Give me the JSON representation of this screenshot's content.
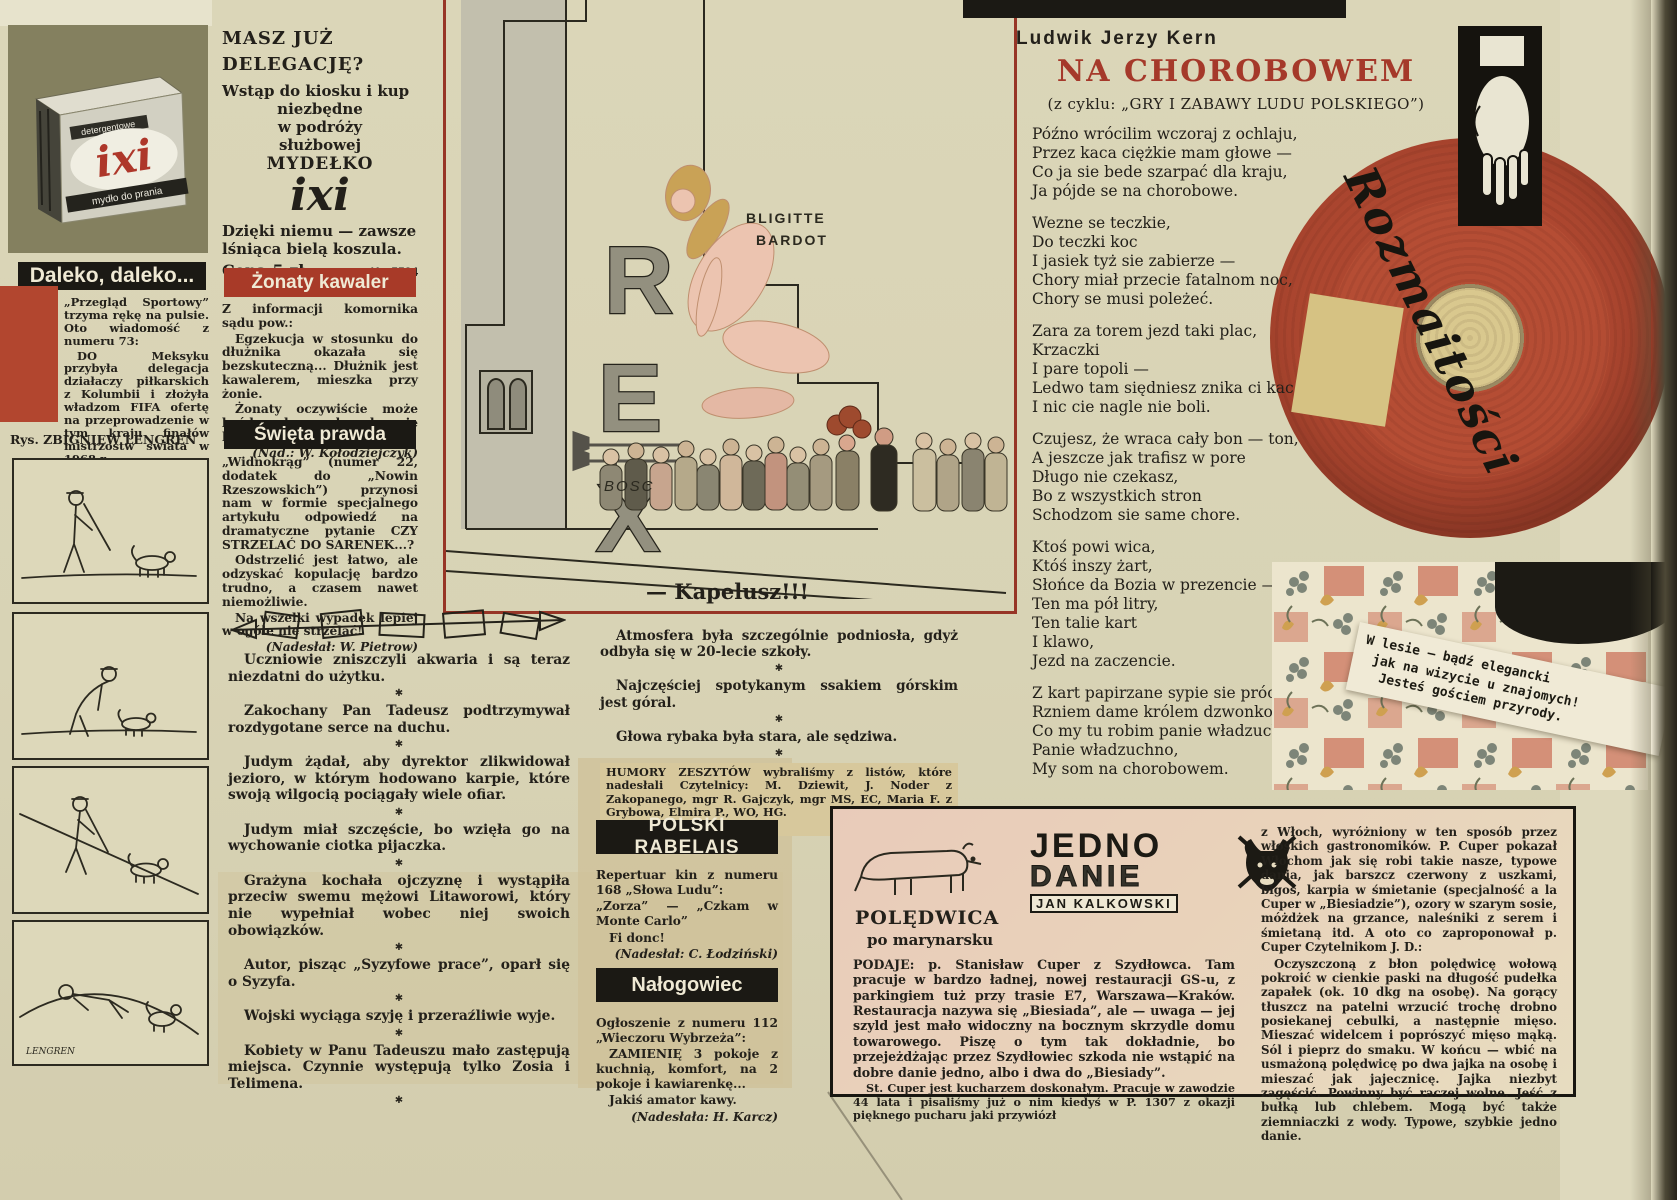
{
  "misc": {
    "star": "✱"
  },
  "ixi_ad": {
    "box_label_top": "detergentowe",
    "box_brand": "ixi",
    "box_label_bottom": "mydło do prania",
    "headline1": "MASZ JUŻ",
    "headline2": "DELEGACJĘ?",
    "line1": "Wstąp do kiosku i kup",
    "line2": "niezbędne",
    "line3": "w podróży",
    "line4": "służbowej",
    "line5": "MYDEŁKO",
    "brand_big": "ixi",
    "slogan1": "Dzięki niemu — zawsze",
    "slogan2": "lśniąca bielą koszula.",
    "price": "Cena 5 zł.",
    "code": "K—5524"
  },
  "daleko": {
    "title": "Daleko, daleko...",
    "p1": "„Przegląd Sportowy” trzyma rękę na pulsie. Oto wiadomość z numeru 73:",
    "p2": "DO Meksyku przybyła delegacja działaczy piłkarskich z Kolumbii i złożyła władzom FIFA ofertę na przeprowadzenie w tym kraju finałów mistrzostw świata w 1968 r.",
    "p3": "Zaczynamy grać do tyłu?",
    "credit": "(Nadesłał: J. Tuna)"
  },
  "lengren": {
    "credit": "Rys. ZBIGNIEW LENGREN",
    "signature": "LENGREN"
  },
  "zonaty": {
    "title": "Żonaty kawaler",
    "p1": "Z informacji komornika sądu pow.:",
    "p2": "Egzekucja w stosunku do dłużnika okazała się bezskuteczną... Dłużnik jest kawalerem, mieszka przy żonie.",
    "p3": "Żonaty oczywiście może być kawalerem ale wyłącznie kawalerem orderu.",
    "credit": "(Nad.: W. Kołodziejczyk)"
  },
  "swieta": {
    "title": "Święta prawda",
    "p1": "„Widnokrąg” (numer 22, dodatek do „Nowin Rzeszowskich”) przynosi nam w formie specjalnego artykułu odpowiedź na dramatyczne pytanie CZY STRZELAĆ DO SARENEK...?",
    "p2": "Odstrzelić jest łatwo, ale odzyskać kopulację bardzo trudno, a czasem nawet niemożliwie.",
    "p3": "Na wszelki wypadek lepiej w ogóle nie strzelać!",
    "credit": "(Nadesłał: W. Pietrow)"
  },
  "cartoon": {
    "sign_letter1": "R",
    "sign_letter2": "E",
    "sign_letter3": "X",
    "poster_line1": "BLIGITTE",
    "poster_line2": "BARDOT",
    "signature": "BOSC",
    "caption": "— Kapelusz!!!"
  },
  "poem": {
    "author": "Ludwik Jerzy Kern",
    "title": "NA CHOROBOWEM",
    "subtitle": "(z cyklu: „GRY I ZABAWY LUDU POLSKIEGO”)",
    "stanzas": [
      [
        "Późno wrócilim wczoraj z ochlaju,",
        "Przez kaca ciężkie mam głowe —",
        "Co ja sie bede szarpać dla kraju,",
        "Ja pójde se na chorobowe."
      ],
      [
        "Wezne se teczkie,",
        "Do teczki koc",
        "I jasiek tyż sie zabierze —",
        "Chory miał przecie fatalnom noc,",
        "Chory se musi poleżeć."
      ],
      [
        "Zara za torem jezd taki plac,",
        "Krzaczki",
        "I pare topoli —",
        "Ledwo tam siędniesz znika ci kac",
        "I nic cie nagle nie boli."
      ],
      [
        "Czujesz, że wraca cały bon — ton,",
        "A jeszcze jak trafisz w pore",
        "Długo nie czekasz,",
        "Bo z wszystkich stron",
        "Schodzom sie same chore."
      ],
      [
        "Ktoś powi wica,",
        "Któś inszy żart,",
        "Słońce da Bozia w prezencie —",
        "Ten ma pół litry,",
        "Ten talie kart",
        "I klawo,",
        "Jezd na zaczencie."
      ],
      [
        "Z kart papirzane sypie sie próchno,",
        "Rzniem dame królem dzwonkowem —",
        "Co my tu robim panie władzuchno?",
        "Panie władzuchno,",
        "My som na chorobowem."
      ]
    ]
  },
  "rozmaitosci": {
    "label": "Rozmaitości"
  },
  "forest_note": {
    "line1": "W lesie — bądź elegancki",
    "line2": "jak na wizycie u znajomych!",
    "line3": "Jesteś gościem przyrody."
  },
  "center_quotes": {
    "q1": "Atmosfera była szczególnie podniosła, gdyż odbyła się w 20-lecie szkoły.",
    "q2": "Najczęściej spotykanym ssakiem górskim jest góral.",
    "q3": "Głowa rybaka była stara, ale sędziwa.",
    "credit": "HUMORY ZESZYTÓW wybraliśmy z listów, które nadesłali Czytelnicy: M. Dziewit, J. Noder z Zakopanego, mgr R. Gajczyk, mgr MS, EC, Maria F. z Grybowa, Elmira P., WO, HG.",
    "thanks": "Dziękujemy."
  },
  "left_quotes": [
    "Uczniowie zniszczyli akwaria i są teraz niezdatni do użytku.",
    "Zakochany Pan Tadeusz podtrzymywał rozdygotane serce na duchu.",
    "Judym żądał, aby dyrektor zlikwidował jezioro, w którym hodowano karpie, które swoją wilgocią pociągały wiele ofiar.",
    "Judym miał szczęście, bo wzięła go na wychowanie ciotka pijaczka.",
    "Grażyna kochała ojczyznę i wystąpiła przeciw swemu mężowi Litaworowi, który nie wypełniał wobec niej swoich obowiązków.",
    "Autor, pisząc „Syzyfowe prace”, oparł się o Syzyfa.",
    "Wojski wyciąga szyję i przeraźliwie wyje.",
    "Kobiety w Panu Tadeuszu mało zastępują miejsca. Czynnie występują tylko Zosia i Telimena."
  ],
  "rabelais": {
    "title": "POLSKI RABELAIS",
    "p1": "Repertuar kin z numeru 168 „Słowa Ludu”:",
    "p2": "„Zorza” — „Czkam w Monte Carlo”",
    "p3": "Fi donc!",
    "credit": "(Nadesłał: C. Łodziński)"
  },
  "nalogowiec": {
    "title": "Nałogowiec",
    "p1": "Ogłoszenie z numeru 112 „Wieczoru Wybrzeża”:",
    "p2": "ZAMIENIĘ 3 pokoje z kuchnią, komfort, na 2 pokoje i kawiarenkę...",
    "p3": "Jakiś amator kawy.",
    "credit": "(Nadesłała: H. Karcz)"
  },
  "recipe": {
    "stamp_line1": "JEDNO",
    "stamp_line2": "DANIE",
    "stamp_line3": "JAN KALKOWSKI",
    "title": "POLĘDWICA",
    "subtitle": "po marynarsku",
    "left_p1": "PODAJE: p. Stanisław Cuper z Szydłowca. Tam pracuje w bardzo ładnej, nowej restauracji GS-u, z parkingiem tuż przy trasie E7, Warszawa—Kraków. Restauracja nazywa się „Biesiada”, ale — uwaga — jej szyld jest mało widoczny na bocznym skrzydle domu towarowego. Piszę o tym tak dokładnie, bo przejeżdżając przez Szydłowiec szkoda nie wstąpić na dobre danie jedno, albo i dwa do „Biesiady”.",
    "left_p2": "St. Cuper jest kucharzem doskonałym. Pracuje w zawodzie 44 lata i pisaliśmy już o nim kiedyś w P. 1307 z okazji pięknego pucharu jaki przywiózł",
    "right_p1": "z Włoch, wyróżniony w ten sposób przez włoskich gastronomików. P. Cuper pokazał Włochom jak się robi takie nasze, typowe dania, jak barszcz czerwony z uszkami, bigos, karpia w śmietanie (specjalność a la Cuper w „Biesiadzie”), ozory w szarym sosie, móżdżek na grzance, naleśniki z serem i śmietaną itd. A oto co zaproponował p. Cuper Czytelnikom J. D.:",
    "right_p2": "Oczyszczoną z błon polędwicę wołową pokroić w cienkie paski na długość pudełka zapałek (ok. 10 dkg na osobę). Na gorący tłuszcz na patelni wrzucić trochę drobno posiekanej cebulki, a następnie mięso. Mieszać widelcem i poprószyć mięso mąką. Sól i pieprz do smaku. W końcu — wbić na usmażoną polędwicę po dwa jajka na osobę i mieszać jak jajecznicę. Jajka niezbyt zagęścić. Powinny być raczej wolne. Jeść z bułką lub chlebem. Mogą być także ziemniaczki z wody. Typowe, szybkie jedno danie."
  },
  "colors": {
    "accent_red": "#a83a28",
    "record_red": "#b14a33",
    "header_black": "#1b1914"
  }
}
